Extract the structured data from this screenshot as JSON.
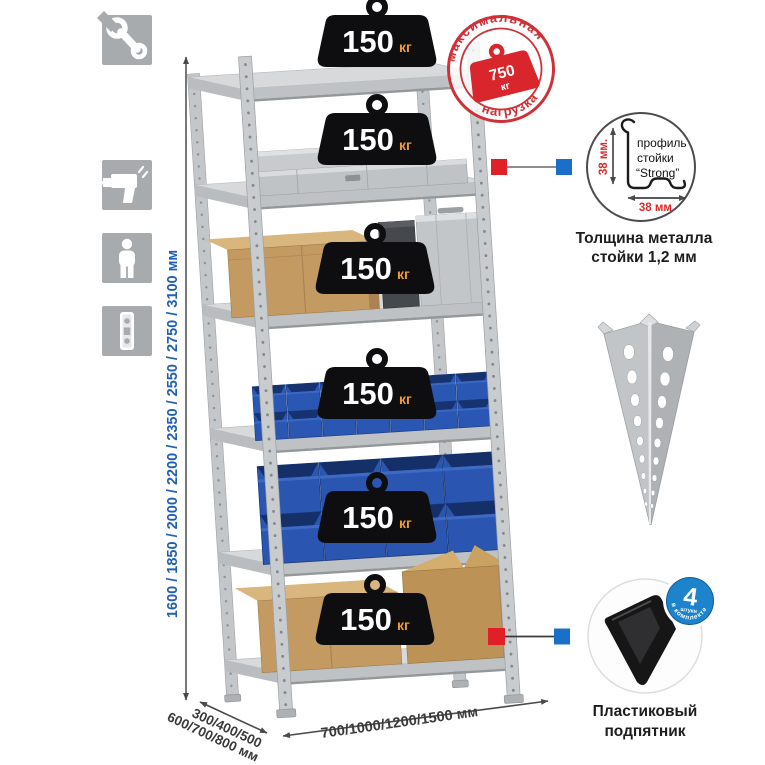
{
  "left_toolbar": {
    "icons": [
      {
        "name": "wrench"
      },
      {
        "name": "gloves"
      },
      {
        "name": "drill"
      },
      {
        "name": "person"
      },
      {
        "name": "post-profile-strip"
      }
    ]
  },
  "dimensions": {
    "height_label": "1600 / 1850 / 2000 / 2200 / 2350 / 2550 / 2750 / 3100 мм",
    "depth_label_line1": "300/400/500",
    "depth_label_line2": "600/700/800 мм",
    "width_label": "700/1000/1200/1500 мм"
  },
  "shelf_badges": [
    {
      "value": "150",
      "unit": "кг"
    },
    {
      "value": "150",
      "unit": "кг"
    },
    {
      "value": "150",
      "unit": "кг"
    },
    {
      "value": "150",
      "unit": "кг"
    },
    {
      "value": "150",
      "unit": "кг"
    },
    {
      "value": "150",
      "unit": "кг"
    }
  ],
  "max_load_stamp": {
    "arc_top": "максимальная",
    "arc_bottom": "нагрузка",
    "value": "750",
    "unit": "кг"
  },
  "profile_detail": {
    "label_line1": "профиль",
    "label_line2": "стойки",
    "label_line3": "“Strong”",
    "dim_vertical": "38 мм.",
    "dim_horizontal": "38 мм.",
    "caption_line1": "Толщина металла",
    "caption_line2": "стойки 1,2 мм"
  },
  "foot_detail": {
    "badge_value": "4",
    "badge_unit": "штуки",
    "badge_arc": "в комплекте",
    "caption_line1": "Пластиковый",
    "caption_line2": "подпятник"
  },
  "colors": {
    "accent_red": "#d8262c",
    "accent_blue": "#1a70c8",
    "bin_blue": "#2a55b0",
    "height_text_blue": "#1f5fb4",
    "badge_unit_orange": "#ef9b31",
    "metal_gray": "#c9ccce"
  }
}
